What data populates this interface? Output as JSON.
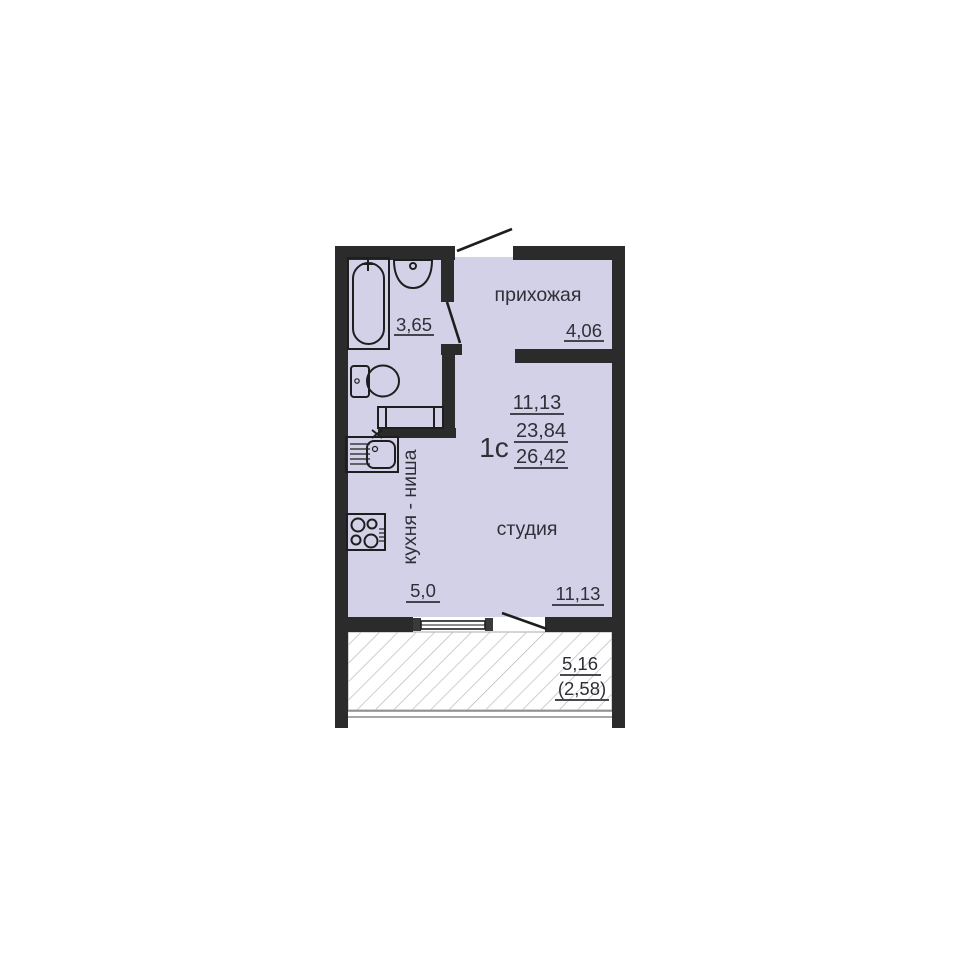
{
  "colors": {
    "wall": "#2b2b2b",
    "floor": "#d3d1e7",
    "outline": "#1e1e1e",
    "text": "#2f2f38",
    "hatch_line": "#b9b9b9"
  },
  "apartment": {
    "type": "1с",
    "living_area": "11,13",
    "area_without_balcony": "23,84",
    "total_area": "26,42"
  },
  "rooms": {
    "hallway": {
      "name": "прихожая",
      "area": "4,06"
    },
    "bathroom": {
      "area": "3,65"
    },
    "kitchen_niche": {
      "name": "кухня - ниша",
      "area": "5,0"
    },
    "studio": {
      "name": "студия",
      "area": "11,13"
    },
    "balcony": {
      "area": "5,16",
      "area_with_coefficient": "(2,58)"
    }
  }
}
